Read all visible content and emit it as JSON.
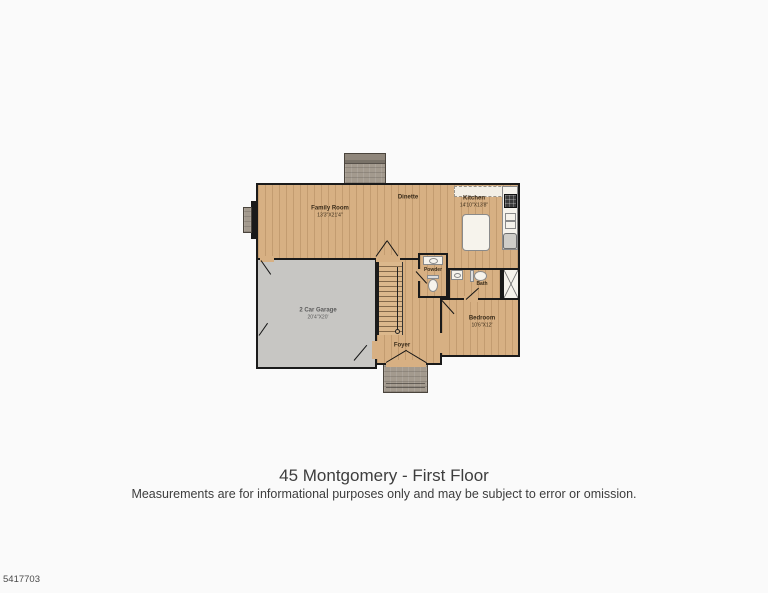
{
  "floor_plan": {
    "rooms": {
      "family_room": {
        "name": "Family Room",
        "dims": "13'3\"X21'4\""
      },
      "dinette": {
        "name": "Dinette"
      },
      "kitchen": {
        "name": "Kitchen",
        "dims": "14'10\"X13'8\""
      },
      "garage": {
        "name": "2 Car Garage",
        "dims": "20'4\"X20'"
      },
      "powder": {
        "name": "Powder"
      },
      "bath": {
        "name": "Bath"
      },
      "bedroom": {
        "name": "Bedroom",
        "dims": "10'6\"X12'"
      },
      "foyer": {
        "name": "Foyer"
      }
    },
    "colors": {
      "wood_floor": "#d7b083",
      "garage_floor": "#c7c6c3",
      "wall": "#1a1a1a",
      "masonry": "#a39a8e",
      "background": "#fafafa"
    }
  },
  "caption": {
    "title": "45 Montgomery - First Floor",
    "disclaimer": "Measurements are for informational purposes only and may be subject to error or omission."
  },
  "footer": {
    "photo_id": "5417703"
  }
}
